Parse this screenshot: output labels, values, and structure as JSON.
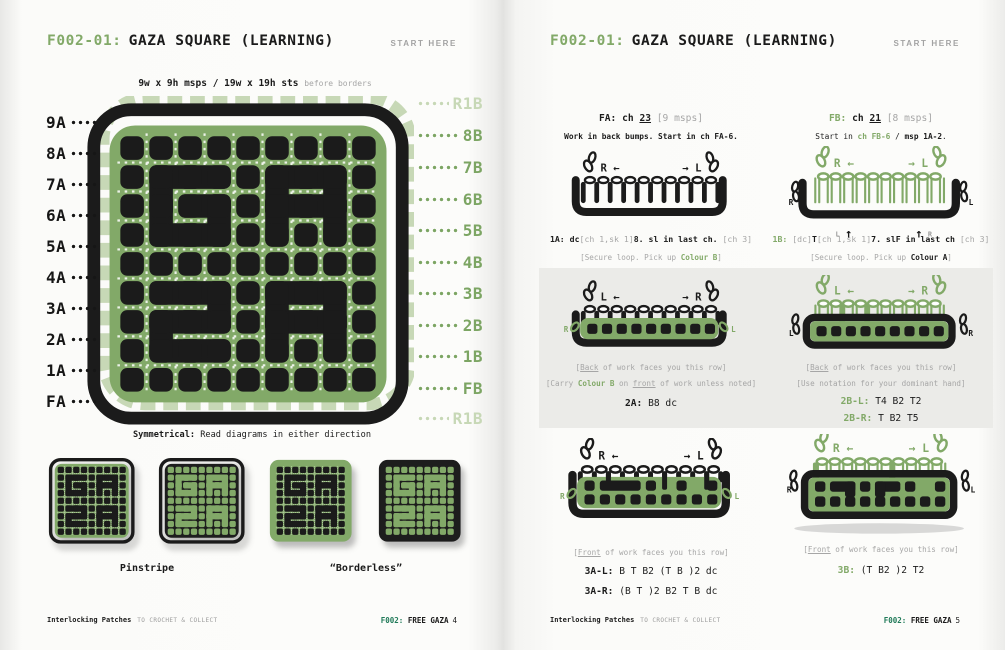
{
  "colors": {
    "green": "#82a968",
    "light_green": "#c7d8b6",
    "black": "#1b1b1b",
    "gray_text": "#a6a6a6",
    "band_bg": "#ebebe8",
    "footer_green": "#1f7a58"
  },
  "header": {
    "code": "F002-01:",
    "title": "GAZA SQUARE (LEARNING)",
    "start_here": "START HERE"
  },
  "footer": {
    "brand": "Interlocking Patches",
    "tagline": "TO CROCHET & COLLECT",
    "code": "F002:",
    "series": "FREE GAZA",
    "page_left": "4",
    "page_right": "5"
  },
  "left_page": {
    "subtitle": "9w x 9h msps / 19w x 19h sts",
    "subtitle_note": "before borders",
    "labels_left": [
      "9A",
      "8A",
      "7A",
      "6A",
      "5A",
      "4A",
      "3A",
      "2A",
      "1A",
      "FA"
    ],
    "labels_right": [
      "R1B",
      "8B",
      "7B",
      "6B",
      "5B",
      "4B",
      "3B",
      "2B",
      "1B",
      "FB",
      "R1B"
    ],
    "symmetry_lead": "Symmetrical:",
    "symmetry_text": " Read diagrams in either direction",
    "swatch_labels": [
      "Pinstripe",
      "“Borderless”"
    ],
    "pattern": {
      "grid": 9,
      "letters": "GAZA",
      "bridges_h": [
        [
          2,
          2
        ],
        [
          3,
          2
        ],
        [
          2,
          4
        ],
        [
          3,
          4
        ],
        [
          3,
          3
        ],
        [
          6,
          2
        ],
        [
          7,
          2
        ],
        [
          6,
          3
        ],
        [
          7,
          3
        ],
        [
          2,
          6
        ],
        [
          3,
          6
        ],
        [
          2,
          7
        ],
        [
          3,
          7
        ],
        [
          2,
          8
        ],
        [
          3,
          8
        ],
        [
          6,
          6
        ],
        [
          7,
          6
        ],
        [
          6,
          7
        ],
        [
          7,
          7
        ]
      ],
      "bridges_v": [
        [
          2,
          2
        ],
        [
          2,
          3
        ],
        [
          4,
          3
        ],
        [
          6,
          2
        ],
        [
          8,
          2
        ],
        [
          6,
          3
        ],
        [
          8,
          3
        ],
        [
          4,
          6
        ],
        [
          2,
          7
        ],
        [
          6,
          6
        ],
        [
          8,
          6
        ],
        [
          6,
          7
        ],
        [
          8,
          7
        ]
      ]
    }
  },
  "right_page": {
    "fa_line": [
      [
        "b",
        "FA: ch "
      ],
      [
        "bu",
        "23"
      ],
      [
        "g",
        " [9 msps]"
      ]
    ],
    "fa_sub": [
      [
        "b",
        "Work in back bumps. Start in ch FA-6."
      ]
    ],
    "fb_line": [
      [
        "gb",
        "FB: "
      ],
      [
        "b",
        "ch "
      ],
      [
        "bu",
        "21"
      ],
      [
        "g",
        " [8 msps]"
      ]
    ],
    "fb_sub": [
      [
        "n",
        "Start in "
      ],
      [
        "gb",
        "ch FB-6"
      ],
      [
        "n",
        " / "
      ],
      [
        "b",
        "msp 1A-2"
      ],
      [
        "n",
        "."
      ]
    ],
    "r1a_line": [
      [
        "b",
        "1A: dc"
      ],
      [
        "g",
        "[ch 1,sk 1]"
      ],
      [
        "b",
        "8. sl in last ch. "
      ],
      [
        "g",
        "[ch 3]"
      ]
    ],
    "r1a_sub": [
      [
        "g",
        "[Secure loop. Pick up "
      ],
      [
        "gb",
        "Colour B"
      ],
      [
        "g",
        "]"
      ]
    ],
    "r1b_line": [
      [
        "gb",
        "1B: "
      ],
      [
        "g",
        "[dc]"
      ],
      [
        "b",
        "T"
      ],
      [
        "g",
        "[ch 1,sk 1]"
      ],
      [
        "b",
        "7. slF in last ch "
      ],
      [
        "g",
        "[ch 3]"
      ]
    ],
    "r1b_sub": [
      [
        "g",
        "[Secure loop. Pick up "
      ],
      [
        "b",
        "Colour A"
      ],
      [
        "g",
        "]"
      ]
    ],
    "back_note": [
      [
        "g",
        "["
      ],
      [
        "gu",
        "Back"
      ],
      [
        "g",
        " of work faces you this row]"
      ]
    ],
    "carry_note": [
      [
        "g",
        "[Carry "
      ],
      [
        "gb",
        "Colour B"
      ],
      [
        "g",
        " on "
      ],
      [
        "gu",
        "front"
      ],
      [
        "g",
        " of work unless noted]"
      ]
    ],
    "r2a_line": [
      [
        "b",
        "2A: "
      ],
      [
        "n",
        "B8 dc"
      ]
    ],
    "hand_note": [
      [
        "g",
        "[Use notation for your dominant hand]"
      ]
    ],
    "r2bl_line": [
      [
        "gb",
        "2B-L: "
      ],
      [
        "n",
        "T4 B2 T2"
      ]
    ],
    "r2br_line": [
      [
        "gb",
        "2B-R: "
      ],
      [
        "n",
        "T B2 T5"
      ]
    ],
    "front_note": [
      [
        "g",
        "["
      ],
      [
        "gu",
        "Front"
      ],
      [
        "g",
        " of work faces you this row]"
      ]
    ],
    "r3al_line": [
      [
        "b",
        "3A-L: "
      ],
      [
        "n",
        "B T B2 (T B )2 dc"
      ]
    ],
    "r3ar_line": [
      [
        "b",
        "3A-R: "
      ],
      [
        "n",
        "(B T )2 B2 T B dc"
      ]
    ],
    "r3b_line": [
      [
        "gb",
        "3B: "
      ],
      [
        "n",
        "(T B2 )2 T2"
      ]
    ],
    "diagram_labels": {
      "d1a": {
        "tl": "R ←",
        "tr": "→ L"
      },
      "d1b": {
        "tl": "R ←",
        "tr": "→ L",
        "sl": "R",
        "sr": "L",
        "ul": "L",
        "ur": "R",
        "up": "↑"
      },
      "d2a": {
        "tl": "L ←",
        "tr": "→ R",
        "sl": "R",
        "sr": "L"
      },
      "d2b": {
        "tl": "L ←",
        "tr": "→ R",
        "sl": "L",
        "sr": "R"
      },
      "d3a": {
        "tl": "R ←",
        "tr": "→ L",
        "sl": "R",
        "sr": "L"
      },
      "d3b": {
        "tl": "R ←",
        "tr": "→ L",
        "sl": "R",
        "sr": "L"
      }
    }
  }
}
